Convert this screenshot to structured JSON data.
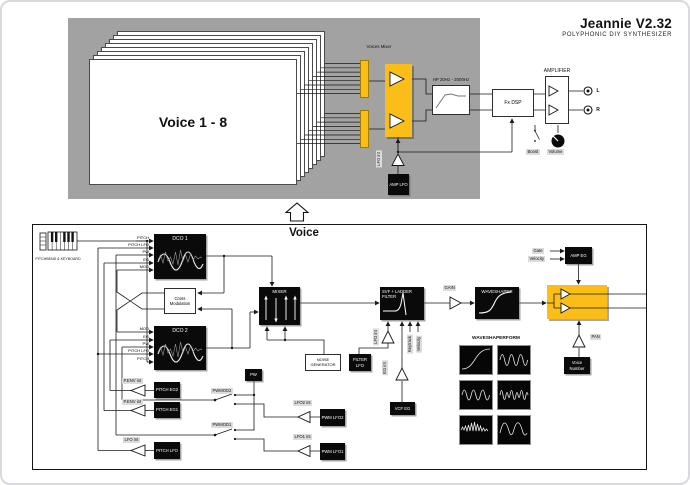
{
  "header": {
    "title": "Jeannie V2.32",
    "subtitle": "POLYPHONIC DIY SYNTHESIZER"
  },
  "top": {
    "voices_card": "Voice 1 - 8",
    "voices_mixer_label": "Voices Mixer",
    "hp_label": "HP 20Hz - 2000Hz",
    "fx_dsp": "Fx DSP",
    "amplifier": "AMPLIFIER",
    "out_l": "L",
    "out_r": "R",
    "boost": "Boost",
    "volume": "Volume",
    "lfo_int": "LFO int",
    "amp_lfo": "AMP LFO"
  },
  "voice": {
    "title": "Voice",
    "keyboard_label": "PITCHBEND & KEYBOARD",
    "dco1": {
      "title": "DCO 1",
      "inputs": [
        "PITCH",
        "PITCH LFO",
        "PW",
        "EG",
        "MOD"
      ]
    },
    "dco2": {
      "title": "DCO 2",
      "inputs": [
        "MOD",
        "EG",
        "PW",
        "PITCH LFO",
        "PITCH"
      ]
    },
    "cross_mod": "Cross Modulation",
    "penv_int": "P.ENV int",
    "pitch_eg2": "PITCH EG2",
    "pitch_eg1": "PITCH EG1",
    "lfo_int": "LFO int",
    "pitch_lfo": "PITCH LFO",
    "pw": "PW",
    "pwmod2": "PWMOD2",
    "pwmod1": "PWMOD1",
    "lfo2_int": "LFO2 int",
    "lfo1_int": "LFO1 int",
    "pwm_lfo2": "PWM LFO2",
    "pwm_lfo1": "PWM LFO1",
    "mixer": "MIXER",
    "noise_gen": "NOISE GENERATOR",
    "filter_lfo": "FILTER LFO",
    "svf_filter": "SVF + LADDER FILTER",
    "eg_int": "EG int",
    "keytrack": "Keytrack",
    "velocity": "Velocity",
    "vcf_eg": "VCF EG",
    "gain": "GAIN",
    "waveshaper": "WAVESHAPER",
    "waveshaperform": "WAVESHAPERFORM",
    "gate": "Gate",
    "amp_eg": "AMP EG",
    "pan": "PAN",
    "voice_number": "Voice Number"
  },
  "colors": {
    "accent": "#FBBE18",
    "panel": "#A2A2A2",
    "ink": "#141414"
  }
}
